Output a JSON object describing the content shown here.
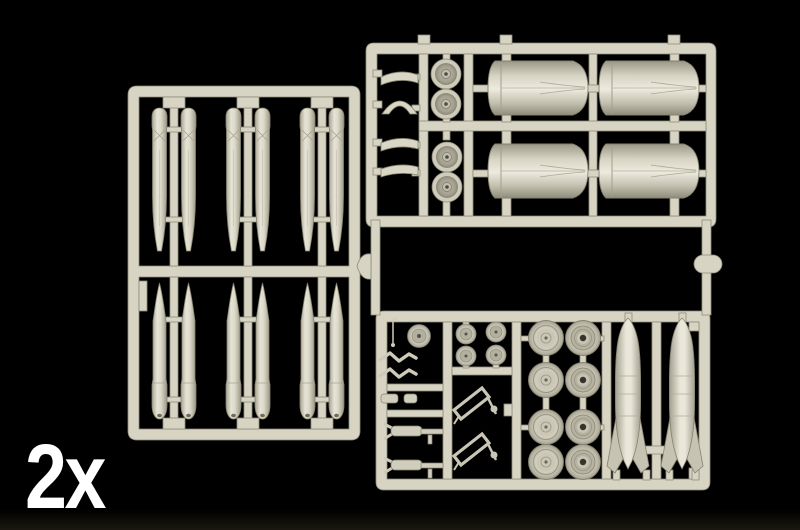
{
  "photo": {
    "background_color": "#000000",
    "quantity_label": "2x",
    "quantity_label_color": "#ffffff",
    "plastic_color": "#d7d4c3",
    "plastic_highlight_color": "#efede1",
    "plastic_shadow_color": "#8e8b7b",
    "wheel_hub_hole_color": "#35332a",
    "sprues": [
      {
        "name": "stores-sprue",
        "position": "left",
        "part_groups": [
          {
            "name": "round-nose-store-halves",
            "count": 6
          },
          {
            "name": "pointed-missile-halves",
            "count": 6
          }
        ]
      },
      {
        "name": "engines-sprue",
        "position": "top-right",
        "part_groups": [
          {
            "name": "engine-nacelle-halves",
            "count": 4
          },
          {
            "name": "engine-fan-discs",
            "count": 4
          },
          {
            "name": "intake-lip-parts",
            "count": 4
          }
        ]
      },
      {
        "name": "undercarriage-sprue",
        "position": "bottom-right",
        "part_groups": [
          {
            "name": "main-wheel-halves",
            "count": 8
          },
          {
            "name": "wheel-hub-discs",
            "count": 4
          },
          {
            "name": "drop-tank-halves",
            "count": 2
          },
          {
            "name": "landing-gear-legs",
            "count": 2
          },
          {
            "name": "retraction-struts",
            "count": 2
          },
          {
            "name": "torque-links",
            "count": 2
          },
          {
            "name": "small-cylinder-parts",
            "count": 2
          },
          {
            "name": "nose-wheel-disc",
            "count": 1
          },
          {
            "name": "pitot-antenna",
            "count": 1
          }
        ]
      }
    ]
  }
}
